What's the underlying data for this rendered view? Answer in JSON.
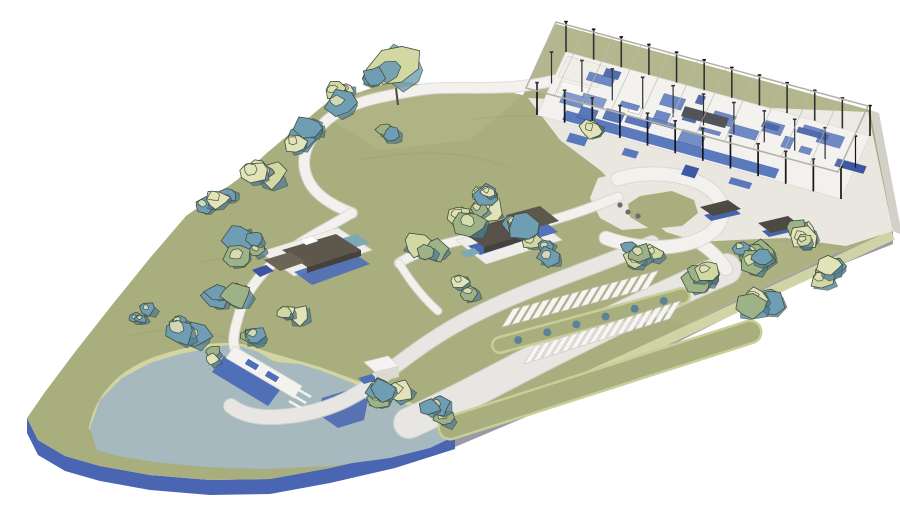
{
  "scene": {
    "type": "architectural-site-plan-3d-rendering",
    "background": "#ffffff",
    "width": 900,
    "height": 506
  },
  "palette": {
    "grass": "#a9ae7e",
    "grass_light": "#b8bc8c",
    "bank": "#d6d9a4",
    "bank_soft": "#c9cd96",
    "tree_light": "#d3d8a3",
    "tree_sage": "#9db387",
    "tree_teal": "#6f9db4",
    "tree_teal_dark": "#4d7b96",
    "tree_pale": "#e2e3b8",
    "tree_outline": "#41503f",
    "path": "#f2f1ee",
    "path_edge": "#d5d4cf",
    "road": "#e7e6e2",
    "lake": "#a5b9be",
    "pond": "#4e6ab1",
    "plinth_blue": "#4a66b2",
    "plinth_gray": "#9a99a8",
    "plinth_light": "#d3d0ca",
    "plaza": "#eae7e0",
    "roof_dark": "#5d574c",
    "roof_darker": "#4e4a42",
    "roof_side": "#46423b",
    "bldg_blue": "#4f6fb7",
    "bldg_blue_dark": "#3b55a0",
    "bldg_white": "#efeeea",
    "teal_deck": "#7fa8b5",
    "pav_floor": "#f2f1ed",
    "pav_blue": "#5273bb",
    "pav_blue_dark": "#33509e",
    "pav_accent": "#6e89c6",
    "pav_gray": "#3a3d42",
    "pav_cream": "#efece6",
    "column": "#15151a",
    "frame": "#b5b0a7",
    "contour": "#8f966c",
    "table_dot": "#6a6d72"
  },
  "features": {
    "pavilion": {
      "name": "open-frame-pavilion",
      "columns_front": 12,
      "columns_back": 12,
      "columns_mid": 11,
      "trusses": 10,
      "interior_blocks": 26,
      "spill_blocks": 4
    },
    "parking": {
      "name": "angled-parking",
      "rows": [
        {
          "stalls": 15
        },
        {
          "stalls": 16
        }
      ],
      "median_bushes": 6
    },
    "lake": {
      "name": "lake"
    },
    "pond": {
      "name": "dark-pond-patch"
    },
    "pier": {
      "name": "pier-dock",
      "kiosks": 2,
      "finger_piers": 3
    },
    "dropoff": {
      "name": "drop-off-loop",
      "tables": 3
    },
    "buildings": [
      {
        "name": "west-courtyard-building"
      },
      {
        "name": "central-pavilion-cluster"
      },
      {
        "name": "east-garden-pavilion-1"
      },
      {
        "name": "east-garden-pavilion-2"
      },
      {
        "name": "lakeside-hut"
      }
    ],
    "big_tree": {
      "x": 396,
      "y": 64,
      "r": 27
    },
    "vegetation": {
      "name": "tree-clusters",
      "clusters": [
        {
          "x": 368,
          "y": 82,
          "count": 1,
          "size": 11
        },
        {
          "x": 340,
          "y": 97,
          "count": 3,
          "size": 11
        },
        {
          "x": 303,
          "y": 136,
          "count": 4,
          "size": 12
        },
        {
          "x": 258,
          "y": 170,
          "count": 3,
          "size": 11
        },
        {
          "x": 218,
          "y": 202,
          "count": 3,
          "size": 11
        },
        {
          "x": 252,
          "y": 248,
          "count": 4,
          "size": 12
        },
        {
          "x": 228,
          "y": 290,
          "count": 4,
          "size": 12
        },
        {
          "x": 290,
          "y": 312,
          "count": 3,
          "size": 10
        },
        {
          "x": 182,
          "y": 330,
          "count": 4,
          "size": 12
        },
        {
          "x": 212,
          "y": 356,
          "count": 2,
          "size": 10
        },
        {
          "x": 250,
          "y": 332,
          "count": 3,
          "size": 10
        },
        {
          "x": 388,
          "y": 128,
          "count": 2,
          "size": 10
        },
        {
          "x": 472,
          "y": 214,
          "count": 5,
          "size": 12
        },
        {
          "x": 522,
          "y": 232,
          "count": 4,
          "size": 12
        },
        {
          "x": 430,
          "y": 248,
          "count": 3,
          "size": 11
        },
        {
          "x": 556,
          "y": 252,
          "count": 2,
          "size": 10
        },
        {
          "x": 492,
          "y": 194,
          "count": 3,
          "size": 11
        },
        {
          "x": 600,
          "y": 132,
          "count": 2,
          "size": 9
        },
        {
          "x": 642,
          "y": 252,
          "count": 4,
          "size": 11
        },
        {
          "x": 696,
          "y": 272,
          "count": 5,
          "size": 12
        },
        {
          "x": 748,
          "y": 256,
          "count": 5,
          "size": 12
        },
        {
          "x": 792,
          "y": 236,
          "count": 4,
          "size": 11
        },
        {
          "x": 822,
          "y": 272,
          "count": 4,
          "size": 11
        },
        {
          "x": 762,
          "y": 302,
          "count": 4,
          "size": 11
        },
        {
          "x": 390,
          "y": 392,
          "count": 4,
          "size": 11
        },
        {
          "x": 432,
          "y": 412,
          "count": 3,
          "size": 10
        },
        {
          "x": 142,
          "y": 312,
          "count": 3,
          "size": 9
        },
        {
          "x": 462,
          "y": 286,
          "count": 2,
          "size": 9
        }
      ]
    }
  }
}
